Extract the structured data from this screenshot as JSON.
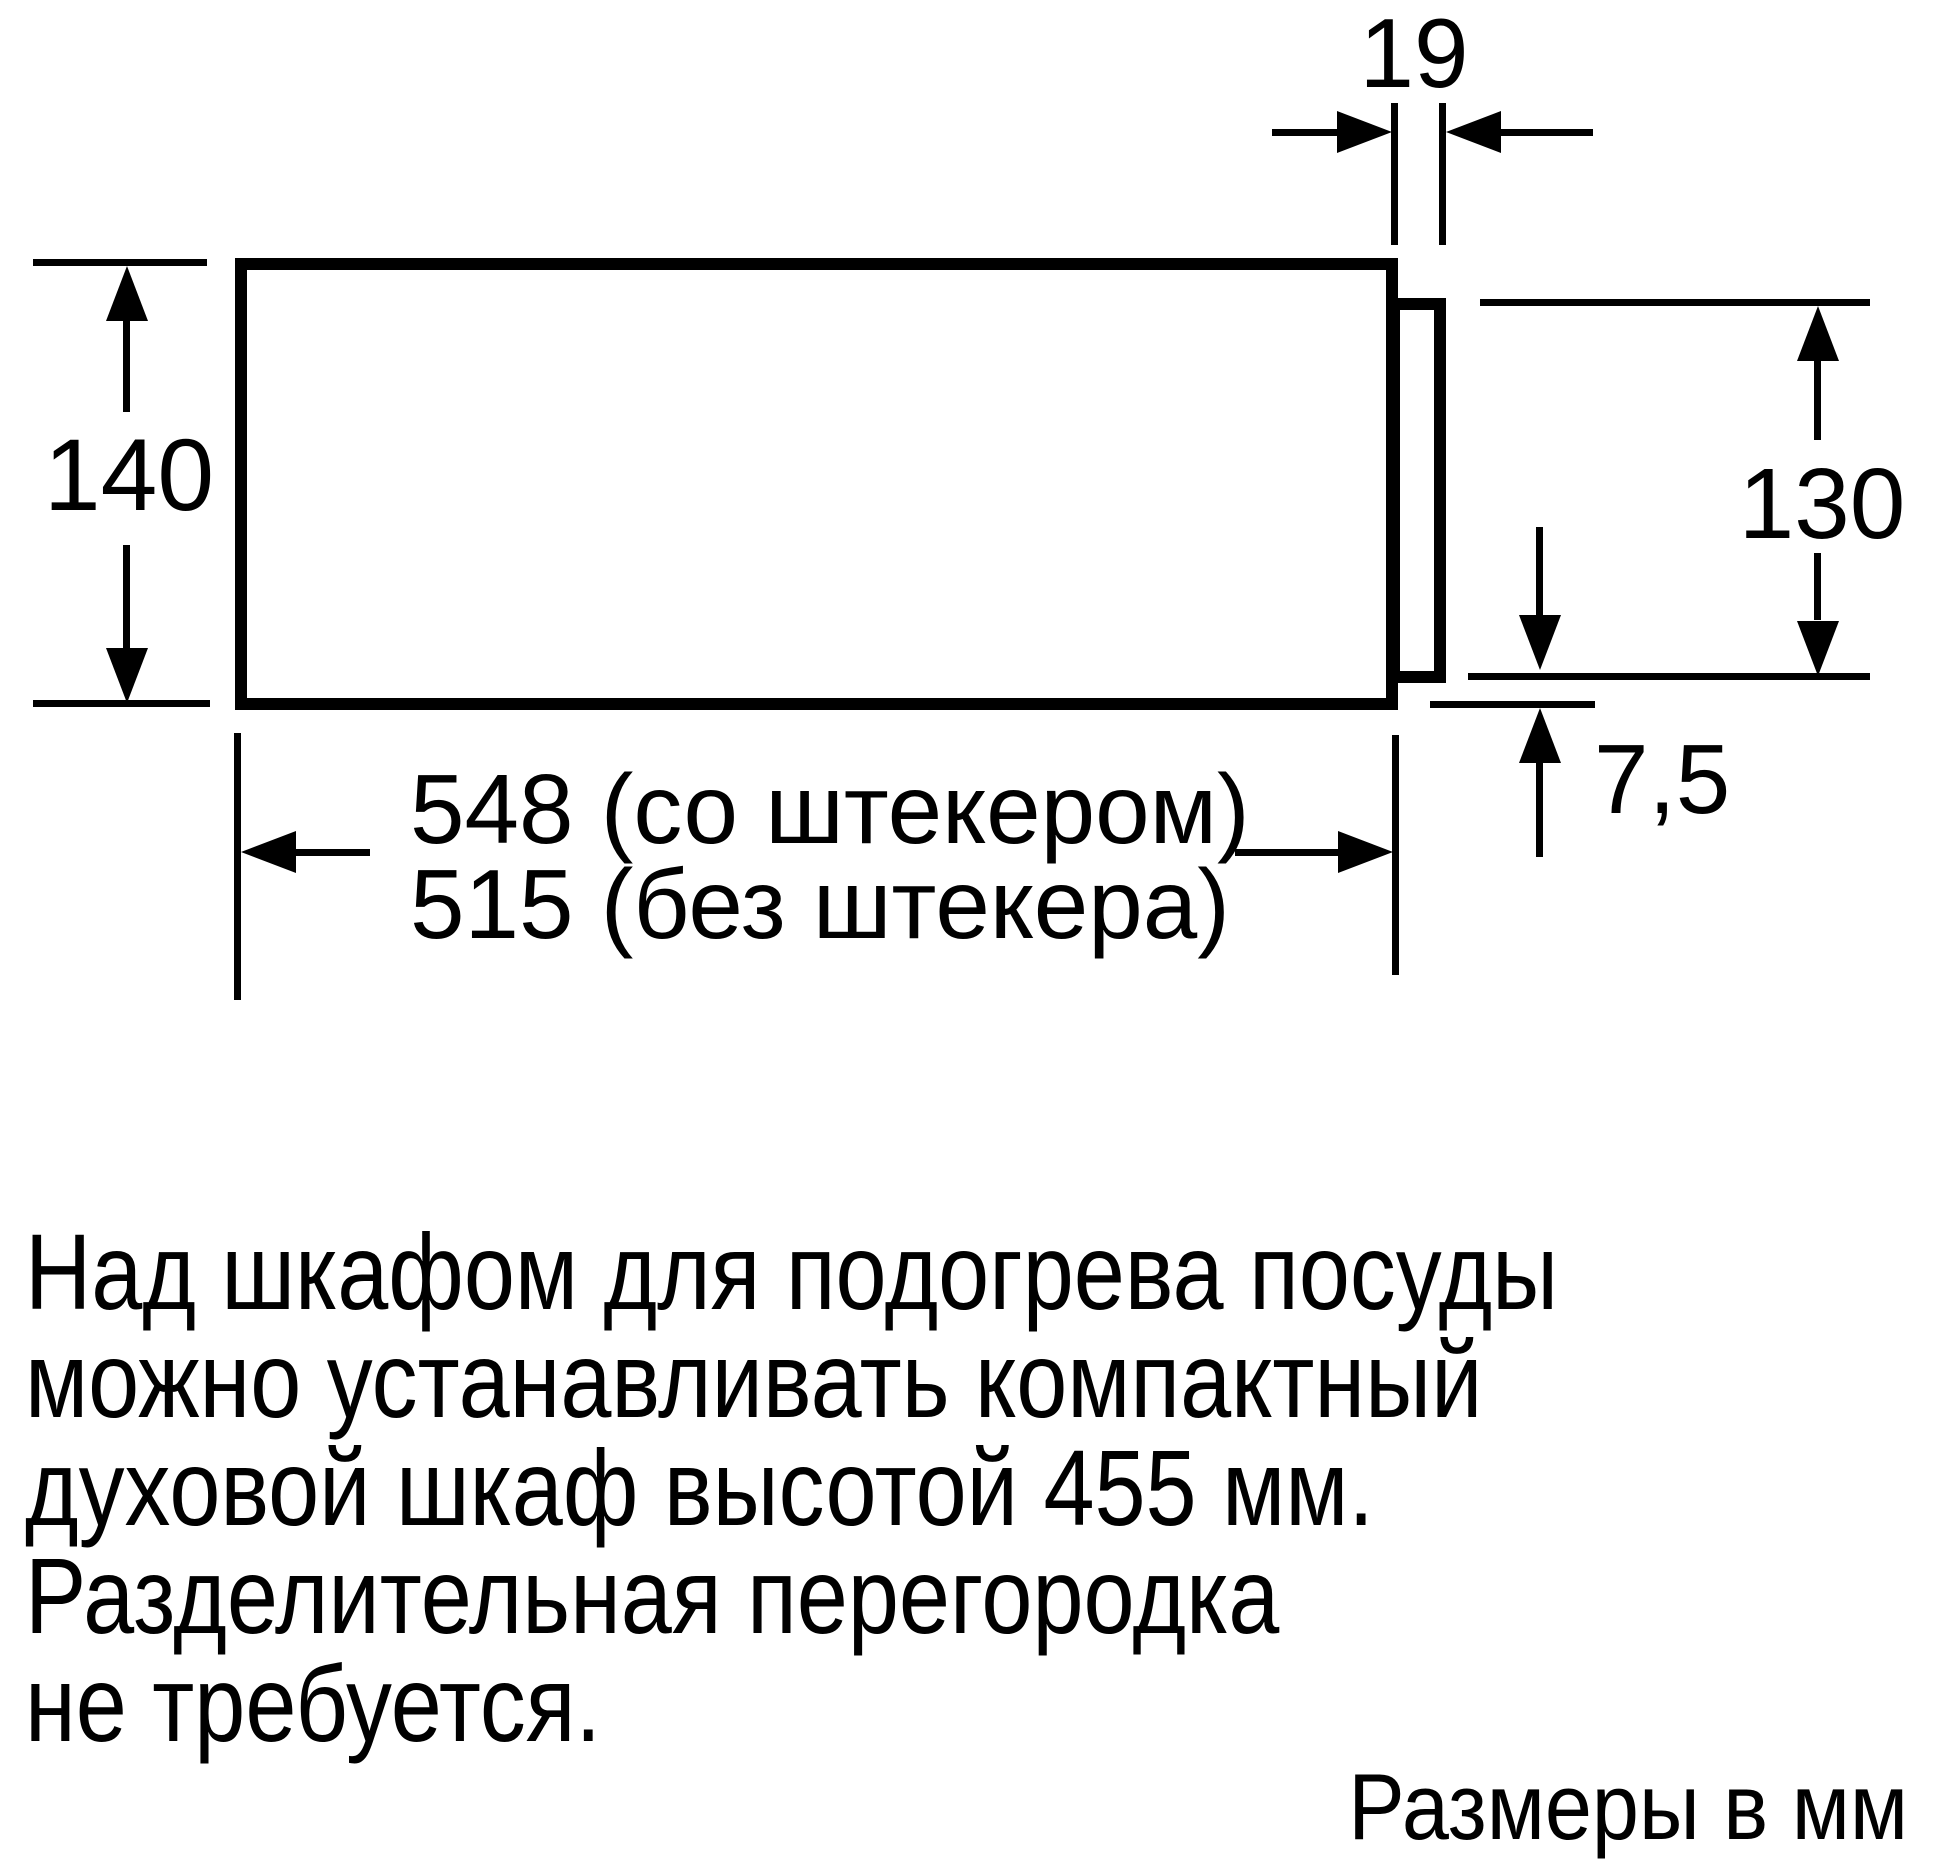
{
  "colors": {
    "ink": "#000000",
    "paper": "#ffffff"
  },
  "drawing": {
    "labels": {
      "panel_thickness_mm": "19",
      "body_height_mm": "140",
      "panel_height_mm": "130",
      "bottom_offset_mm": "7,5",
      "depth_with_plug": "548 (со штекером)",
      "depth_without_plug": "515 (без штекера)"
    }
  },
  "note": {
    "lines": [
      "Над шкафом для подогрева посуды",
      "можно устанавливать компактный",
      "духовой шкаф высотой 455 мм.",
      "Разделительная перегородка",
      "не требуется."
    ]
  },
  "footer": {
    "units": "Размеры в мм"
  }
}
